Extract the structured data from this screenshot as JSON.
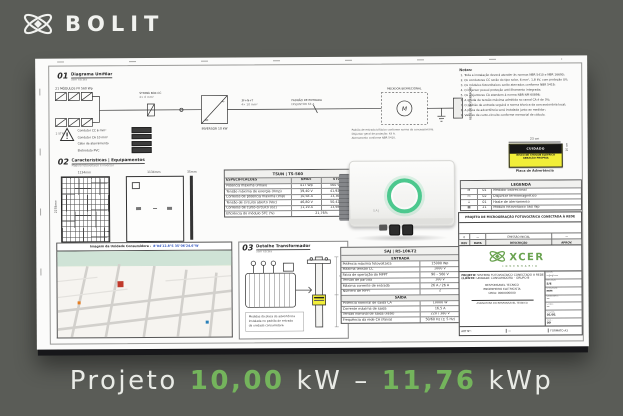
{
  "brand": {
    "name": "BOLIT"
  },
  "footer": {
    "prefix": "Projeto",
    "kw_value": "10,00",
    "kw_unit": "kW",
    "separator": "–",
    "kwp_value": "11,76",
    "kwp_unit": "kWp"
  },
  "colors": {
    "background": "#5a5c57",
    "accent_green": "#74b45c",
    "warning_yellow": "#f1ee39",
    "logo_green": "#6aa351",
    "inverter_ring": "#4cc88e",
    "map_pin_red": "#c0392b"
  },
  "sheet": {
    "sections": {
      "s01_num": "01",
      "s01_title": "Diagrama Unifilar",
      "s01_sub": "Sem escala",
      "s02_num": "02",
      "s02_title": "Características | Equipamentos",
      "s02_sub": "Módulo fotovoltaico e inversor",
      "s03_num": "03",
      "s03_title": "Detalhe Transformador",
      "s03_sub": "Sem escala"
    },
    "diagram": {
      "pv_label": "21 MÓDULOS FV 560 Wp",
      "pv_sub": "2 STRINGS",
      "dc_label1": "STRING BOX CC",
      "dc_label2": "2× 6 mm²",
      "inverter_ac": "~",
      "inverter_dc": "=",
      "inverter_label": "INVERSOR 10 kW",
      "ac_label1": "3F+N+T",
      "ac_label2": "4× 10 mm²",
      "entry_label1": "PADRÃO DE ENTRADA",
      "entry_label2": "DISJUNTOR 63 A",
      "meter_title": "MEDIDOR BIDIRECIONAL",
      "meter_symbol": "M",
      "grid_label": "REDE DE DISTRIBUIÇÃO",
      "obs1": "Padrão de entrada trifásico conforme norma da concessionária.",
      "obs2": "Disjuntor geral de proteção: 63 A.",
      "obs3": "Aterramento conforme NBR 5410.",
      "legend_rows": [
        "Condutor CC 6 mm²",
        "Condutor CA 10 mm²",
        "Cabo de aterramento",
        "Eletroduto PVC"
      ]
    },
    "module_table": {
      "title": "TSUN | TS-560",
      "header": [
        "ESPECIFICAÇÕES",
        "NMOT",
        "STC"
      ],
      "rows": [
        [
          "Potência máxima (Pmax)",
          "417 Wp",
          "560 Wp"
        ],
        [
          "Tensão máxima de energia (Vmp)",
          "39,40 V",
          "41,92 V"
        ],
        [
          "Corrente de potência máxima (Imp)",
          "10,58 A",
          "13,36 A"
        ],
        [
          "Tensão de circuito aberto (Voc)",
          "46,80 V",
          "50,42 V"
        ],
        [
          "Corrente de curto-circuito (Isc)",
          "11,19 A",
          "13,98 A"
        ]
      ],
      "efficiency_label": "Eficiência do módulo STC (%)",
      "efficiency_value": "21,76%"
    },
    "panel_dims": {
      "front_width": "1134mm",
      "front_height": "2278mm",
      "back_width": "1134mm",
      "thickness": "35mm"
    },
    "inverter_photo": {
      "brand": "SAJ"
    },
    "inverter_table": {
      "title": "SAJ | R5-10K-T2",
      "input_header": "ENTRADA",
      "input_rows": [
        [
          "Potência máxima fotovoltaica",
          "15000 Wp"
        ],
        [
          "Máxima tensão CC",
          "1000 V"
        ],
        [
          "Faixa de operação do MPPT",
          "90 – 560 V"
        ],
        [
          "Tensão de partida",
          "100 V"
        ],
        [
          "Máxima corrente de entrada",
          "26 A / 26 A"
        ],
        [
          "Número de MPPT",
          "2"
        ]
      ],
      "output_header": "SAÍDA",
      "output_rows": [
        [
          "Potência nominal de saída CA",
          "10000 W"
        ],
        [
          "Corrente máxima de saída",
          "16,5 A"
        ],
        [
          "Tensão nominal de saída (Fase)",
          "220 / 380 V"
        ],
        [
          "Frequência da rede CA (Faixa)",
          "50/60 Hz (± 5 Hz)"
        ]
      ]
    },
    "map": {
      "caption": "Imagem da Unidade Consumidora -",
      "coords": "8°04'12.8\"S 35°06'24.6\"W"
    },
    "transformer": {
      "note1": "Medidas da placa de advertência",
      "note2": "instalada no padrão de entrada",
      "note3": "da unidade consumidora.",
      "dim1": "0,5 m",
      "dim2": "1,8 m"
    },
    "notes": {
      "title": "Notas:",
      "items": [
        "Toda a instalação deverá atender às normas NBR 5410 e NBR 16690;",
        "Os condutores CC serão do tipo solar, 6 mm², 1,8 kV, com proteção UV;",
        "Os módulos fotovoltaicos serão aterrados conforme NBR 5419;",
        "O inversor possui proteção anti-ilhamento integrada;",
        "Os disjuntores CA atendem à norma NBR NM 60898;",
        "A queda de tensão máxima admitida no ramal CA é de 3%;",
        "O padrão de entrada seguirá a norma técnica da concessionária local;",
        "A placa de advertência será instalada junto ao medidor;",
        "Valores de curto-circuito conforme memorial de cálculo."
      ]
    },
    "plate": {
      "width_dim": "23 cm",
      "height_dim": "10 cm",
      "header": "CUIDADO",
      "line1": "RISCO DE CHOQUE ELÉTRICO",
      "line2": "GERAÇÃO PRÓPRIA",
      "caption": "Placa de Advertência"
    },
    "symbols_table": {
      "title": "LEGENDA",
      "rows": [
        [
          "M",
          "01",
          "Medidor bidirecional"
        ],
        [
          "▭",
          "02",
          "Disjuntor termomagnético"
        ],
        [
          "⏚",
          "01",
          "Haste de aterramento"
        ],
        [
          "▦",
          "21",
          "Módulo fotovoltaico 560 Wp"
        ]
      ]
    },
    "titleblock": {
      "strip_title": "PROJETO DE MICROGERAÇÃO FOTOVOLTAICA CONECTADA À REDE",
      "rev_row": [
        "0",
        "—",
        "EMISSÃO INICIAL",
        "—"
      ],
      "rev_header": [
        "REV",
        "DATA",
        "DESCRIÇÃO",
        "APROV."
      ],
      "logo_text": "XCER",
      "logo_sub": "ENGENHARIA",
      "project_label": "PROJETO:",
      "project_value": "SISTEMA FOTOVOLTAICO CONECTADO À REDE – 10,00 kW / 11,76 kWp",
      "client_label": "CLIENTE:",
      "client_value": "UNIDADE CONSUMIDORA – GRUPO B",
      "resp_name": "RESPONSÁVEL TÉCNICO",
      "resp_title": "ENGENHEIRO ELETRICISTA",
      "resp_crea": "CREA: 0000000000",
      "signature_caption": "ASSINATURA DO RESPONSÁVEL TÉCNICO",
      "fields": [
        {
          "label": "DATA:",
          "value": "--/--/----"
        },
        {
          "label": "ESCALA:",
          "value": "S/E"
        },
        {
          "label": "UNIDADE:",
          "value": "mm"
        },
        {
          "label": "DESENHO:",
          "value": "—"
        },
        {
          "label": "CREA:",
          "value": "—"
        },
        {
          "label": "FOLHA:",
          "value": "01/01"
        },
        {
          "label": "REV.:",
          "value": "00"
        }
      ],
      "art_label": "ART Nº:",
      "art_value": "—",
      "format_label": "FORMATO A3"
    }
  }
}
